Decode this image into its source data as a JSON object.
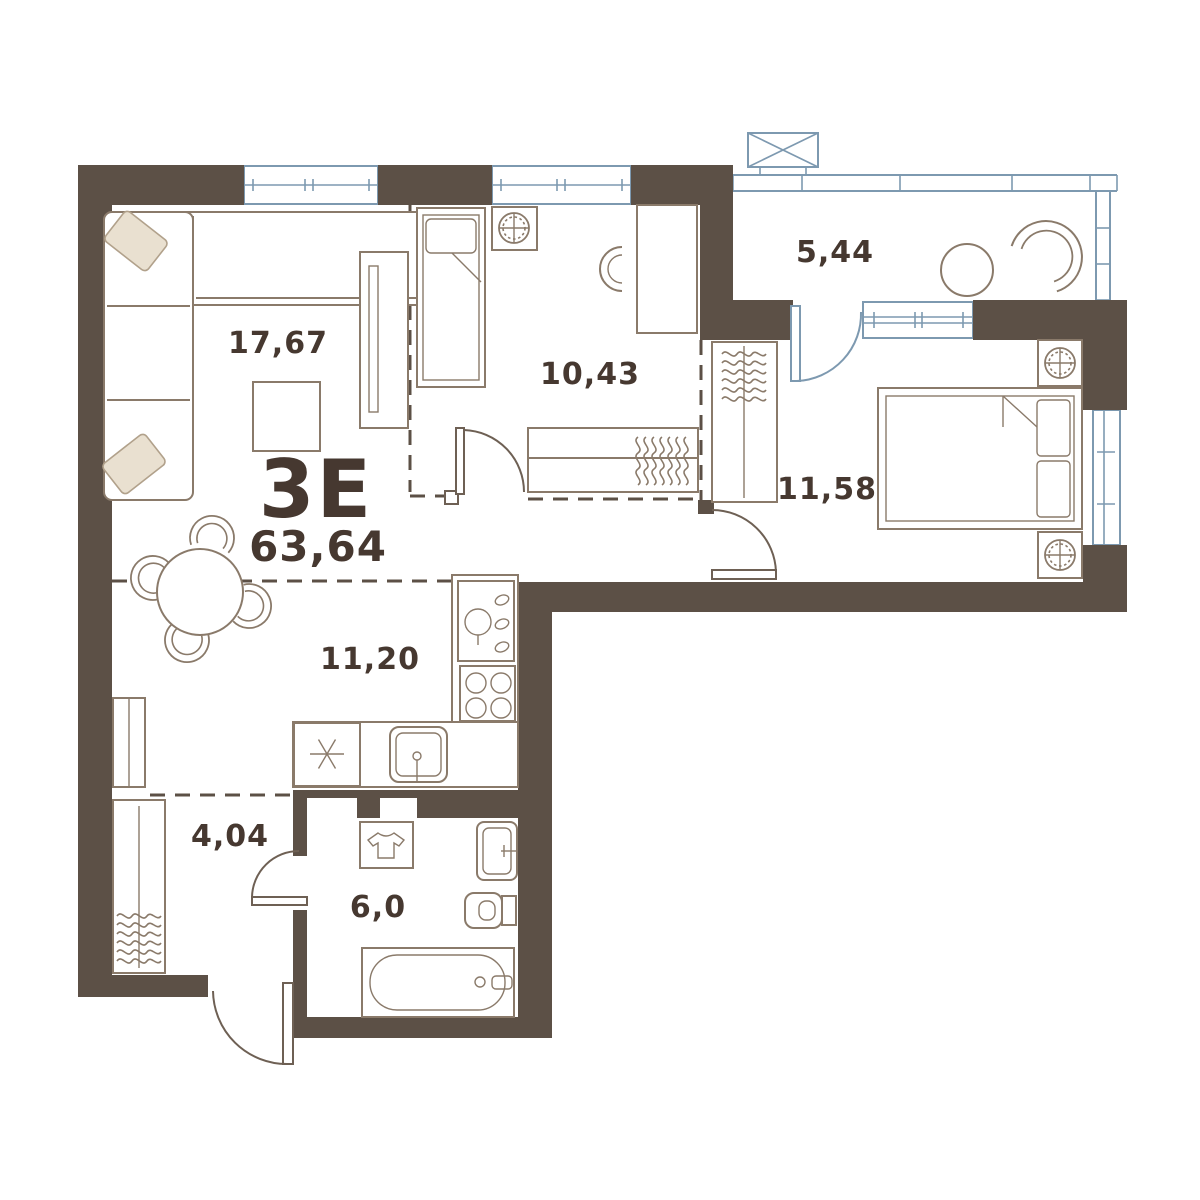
{
  "plan": {
    "unit_type": "3Е",
    "total_area": "63,64",
    "rooms": [
      {
        "id": "living-room",
        "area": "17,67"
      },
      {
        "id": "bedroom",
        "area": "10,43"
      },
      {
        "id": "balcony",
        "area": "5,44"
      },
      {
        "id": "master-bedroom",
        "area": "11,58"
      },
      {
        "id": "kitchen",
        "area": "11,20"
      },
      {
        "id": "hallway",
        "area": "4,04"
      },
      {
        "id": "bathroom",
        "area": "6,0"
      }
    ]
  },
  "colors": {
    "wall": "#5c5046",
    "furniture_line": "#8a7a6a",
    "door_line": "#6e6054",
    "window": "#7d99b0",
    "text": "#463830",
    "pillow": "#e9e0d0",
    "pillow_line": "#b1a18b",
    "background": "#ffffff"
  },
  "icons": [
    "fan-lamp-icon",
    "snowflake-icon",
    "tshirt-icon",
    "stove-burners-icon",
    "sink-icon",
    "droplets-icon",
    "hanger-icon",
    "window-cross-box-icon"
  ]
}
